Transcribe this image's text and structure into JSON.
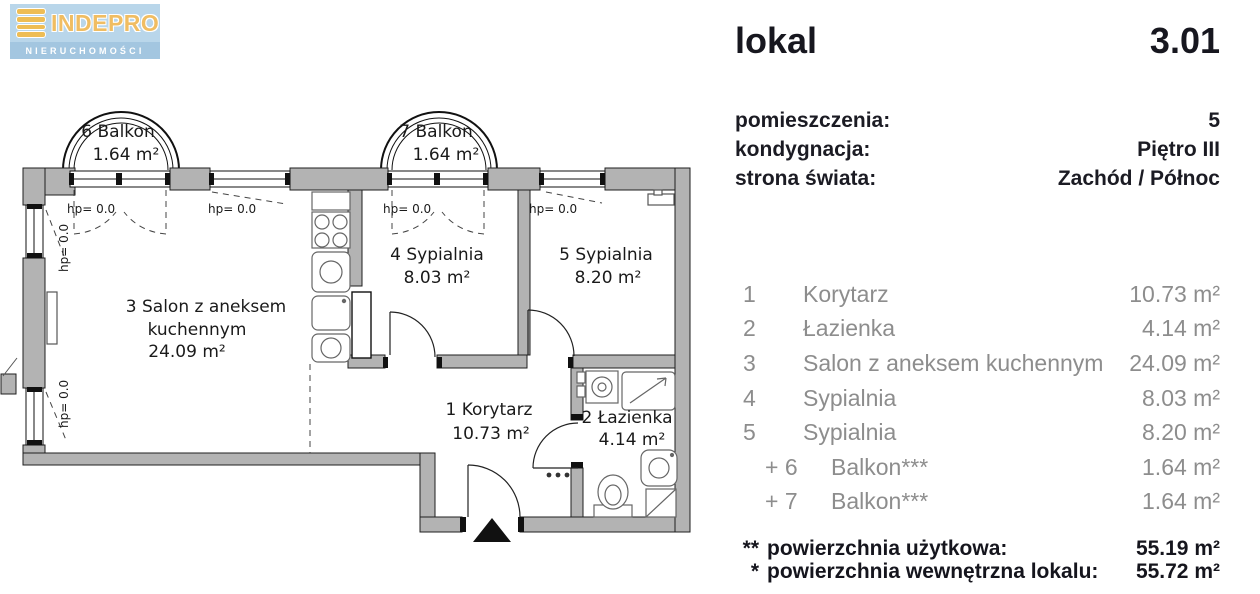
{
  "logo": {
    "brand": "INDEPRO",
    "subtitle": "NIERUCHOMOŚCI"
  },
  "colors": {
    "wall_gray": "#b3b3b3",
    "logo_blue": "#b9d6ea",
    "logo_strip_blue": "#a3c6e0",
    "logo_gold": "#eebd55",
    "list_gray": "#8d8d8d",
    "ink": "#1b1b23"
  },
  "panel": {
    "title": "lokal",
    "unit_number": "3.01",
    "details": [
      {
        "label": "pomieszczenia:",
        "value": "5"
      },
      {
        "label": "kondygnacja:",
        "value": "Piętro III"
      },
      {
        "label": "strona świata:",
        "value": "Zachód / Północ"
      }
    ],
    "rooms": [
      {
        "num": "1",
        "name": "Korytarz",
        "area": "10.73 m²"
      },
      {
        "num": "2",
        "name": "Łazienka",
        "area": "4.14 m²"
      },
      {
        "num": "3",
        "name": "Salon z aneksem kuchennym",
        "area": "24.09 m²"
      },
      {
        "num": "4",
        "name": "Sypialnia",
        "area": "8.03 m²"
      },
      {
        "num": "5",
        "name": "Sypialnia",
        "area": "8.20 m²"
      },
      {
        "num": "+ 6",
        "name": "Balkon***",
        "area": "1.64 m²"
      },
      {
        "num": "+ 7",
        "name": "Balkon***",
        "area": "1.64 m²"
      }
    ],
    "totals": [
      {
        "marker": "**",
        "label": "powierzchnia użytkowa:",
        "value": "55.19 m²"
      },
      {
        "marker": "*",
        "label": "powierzchnia wewnętrzna lokalu:",
        "value": "55.72 m²"
      }
    ]
  },
  "plan": {
    "hp_label": "hp= 0.0",
    "balcony6": {
      "name": "6 Balkon",
      "area": "1.64 m²"
    },
    "balcony7": {
      "name": "7 Balkon",
      "area": "1.64 m²"
    },
    "salon": {
      "line1": "3 Salon z aneksem",
      "line2": "kuchennym",
      "area": "24.09 m²"
    },
    "bedroom4": {
      "name": "4 Sypialnia",
      "area": "8.03 m²"
    },
    "bedroom5": {
      "name": "5 Sypialnia",
      "area": "8.20 m²"
    },
    "corridor": {
      "name": "1 Korytarz",
      "area": "10.73 m²"
    },
    "bathroom": {
      "name": "2 Łazienka",
      "area": "4.14 m²"
    }
  }
}
